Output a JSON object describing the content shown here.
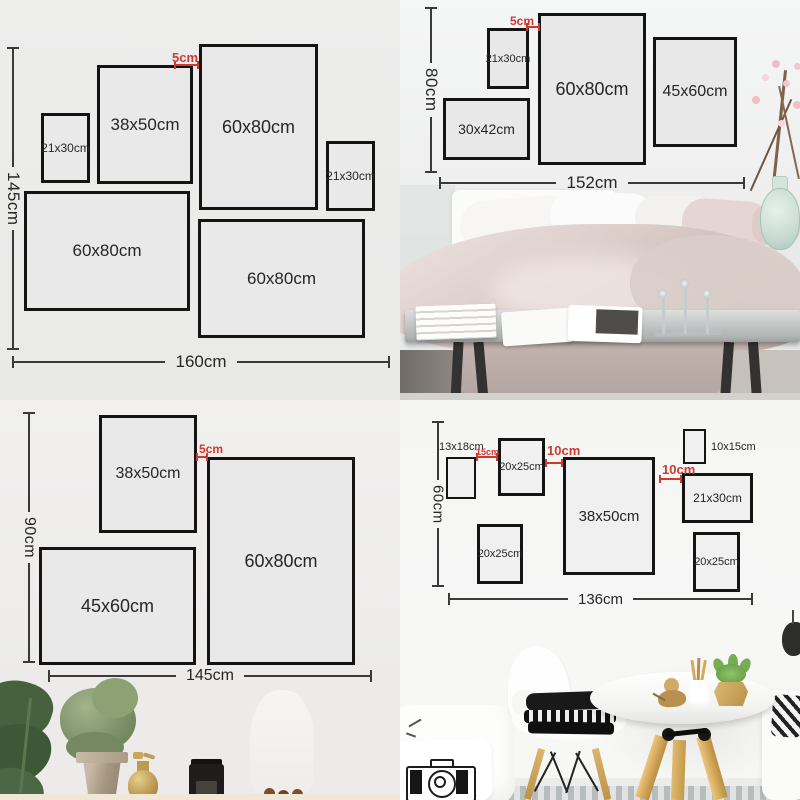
{
  "colors": {
    "accent_red": "#cf3a30",
    "frame_border": "#141414",
    "measure_line": "#3a3a3a",
    "text": "#262626"
  },
  "quadrants": {
    "top_left": {
      "frames": [
        "21x30cm",
        "38x50cm",
        "60x80cm",
        "21x30cm",
        "60x80cm",
        "60x80cm"
      ],
      "gap_label": "5cm",
      "height_label": "145cm",
      "width_label": "160cm"
    },
    "top_right": {
      "frames": [
        "21x30cm",
        "60x80cm",
        "45x60cm",
        "30x42cm"
      ],
      "gap_label": "5cm",
      "height_label": "80cm",
      "width_label": "152cm"
    },
    "bottom_left": {
      "frames": [
        "38x50cm",
        "60x80cm",
        "45x60cm"
      ],
      "gap_label": "5cm",
      "height_label": "90cm",
      "width_label": "145cm"
    },
    "bottom_right": {
      "frames": [
        "20x25cm",
        "38x50cm",
        "21x30cm",
        "20x25cm",
        "20x25cm"
      ],
      "outside_labels": [
        "13x18cm",
        "10x15cm"
      ],
      "gap_labels": [
        "15cm",
        "10cm",
        "10cm"
      ],
      "height_label": "60cm",
      "width_label": "136cm"
    }
  }
}
